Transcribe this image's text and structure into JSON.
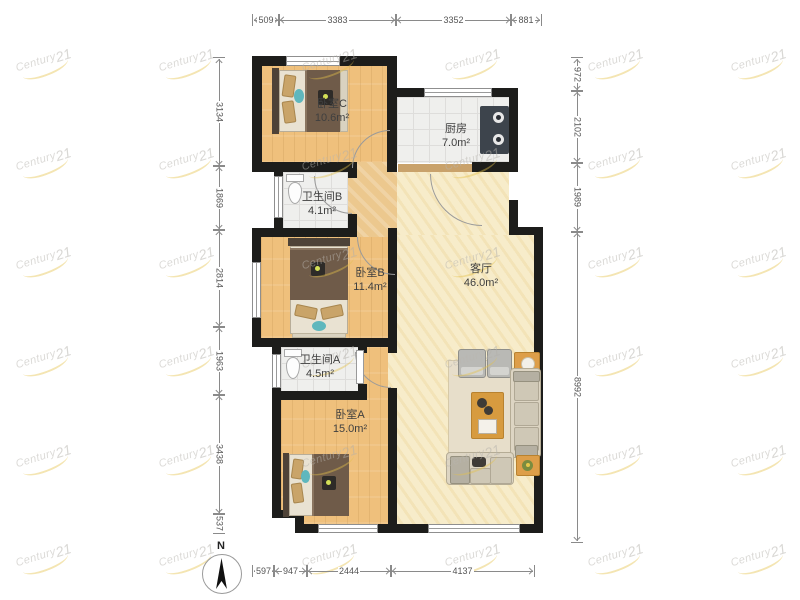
{
  "plan": {
    "rooms": {
      "bedroom_c": {
        "name": "卧室C",
        "area": "10.6m²"
      },
      "kitchen": {
        "name": "厨房",
        "area": "7.0m²"
      },
      "bathroom_b": {
        "name": "卫生间B",
        "area": "4.1m²"
      },
      "bedroom_b": {
        "name": "卧室B",
        "area": "11.4m²"
      },
      "living_room": {
        "name": "客厅",
        "area": "46.0m²"
      },
      "bathroom_a": {
        "name": "卫生间A",
        "area": "4.5m²"
      },
      "bedroom_a": {
        "name": "卧室A",
        "area": "15.0m²"
      }
    },
    "colors": {
      "wall": "#1d1d1b",
      "wood_floor": "#efc07c",
      "tile_floor": "#efefed",
      "living_floor": "#f7ecca",
      "hall_floor": "#ecc88e",
      "accent_table": "#d79b3f",
      "sofa": "#ddd5c3",
      "bed_duvet": "#6f5b49",
      "teal_accent": "#5fb7bd",
      "watermark_gold": "#e4c14a"
    }
  },
  "dimensions": {
    "top": [
      "509",
      "3383",
      "3352",
      "881"
    ],
    "left": [
      "3134",
      "1869",
      "2814",
      "1963",
      "3438",
      "537"
    ],
    "right": [
      "972",
      "2102",
      "1989",
      "8992"
    ],
    "bottom": [
      "597",
      "947",
      "2444",
      "4137"
    ]
  },
  "compass": {
    "label": "N"
  },
  "watermark": {
    "brand": "Century",
    "suffix": "21"
  }
}
